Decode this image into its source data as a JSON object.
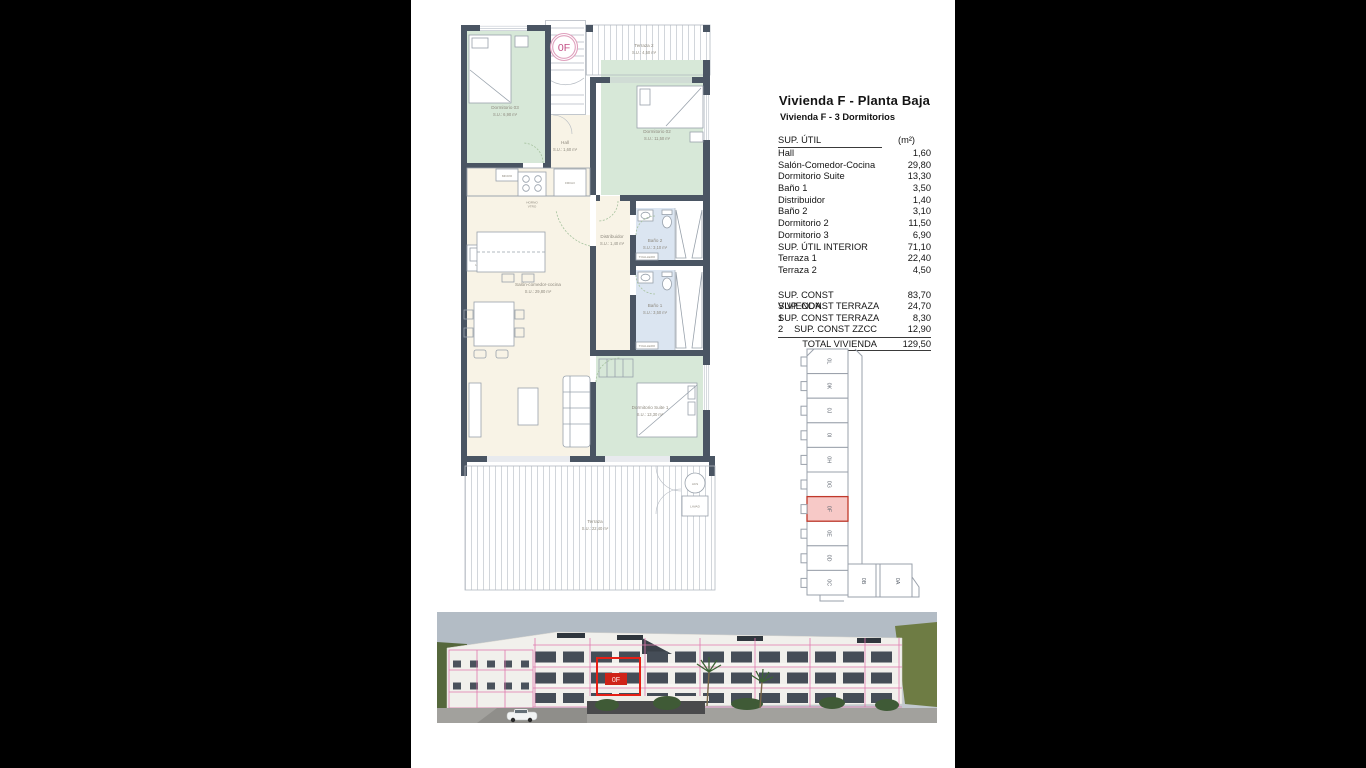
{
  "unit": {
    "code": "0F"
  },
  "header": {
    "title": "Vivienda F - Planta Baja",
    "subtitle": "Vivienda F - 3 Dormitorios"
  },
  "area_table": {
    "header_label": "SUP. ÚTIL",
    "header_unit": "(m²)",
    "rows": [
      {
        "label": "Hall",
        "value": "1,60"
      },
      {
        "label": "Salón-Comedor-Cocina",
        "value": "29,80"
      },
      {
        "label": "Dormitorio Suite",
        "value": "13,30"
      },
      {
        "label": "Baño 1",
        "value": "3,50"
      },
      {
        "label": "Distribuidor",
        "value": "1,40"
      },
      {
        "label": "Baño 2",
        "value": "3,10"
      },
      {
        "label": "Dormitorio 2",
        "value": "11,50"
      },
      {
        "label": "Dormitorio 3",
        "value": "6,90"
      },
      {
        "label": "SUP. ÚTIL INTERIOR",
        "value": "71,10"
      },
      {
        "label": "Terraza 1",
        "value": "22,40"
      },
      {
        "label": "Terraza 2",
        "value": "4,50"
      }
    ],
    "summary_rows": [
      {
        "label": "SUP. CONST VIVIENDA",
        "value": "83,70"
      },
      {
        "label": "SUP. CONST TERRAZA 1",
        "value": "24,70"
      },
      {
        "label": "SUP. CONST TERRAZA 2",
        "value": "8,30"
      },
      {
        "label": "SUP. CONST ZZCC",
        "value": "12,90"
      }
    ],
    "total_row": {
      "label": "TOTAL VIVIENDA",
      "value": "129,50"
    }
  },
  "floor_plan": {
    "rooms": {
      "terraza2": {
        "name": "Terraza 2",
        "area": "S.U.: 4,50 m²"
      },
      "dorm03": {
        "name": "Dormitorio 03",
        "area": "S.U.: 6,90 m²"
      },
      "dorm02": {
        "name": "Dormitorio 02",
        "area": "S.U.: 11,50 m²"
      },
      "hall": {
        "name": "Hall",
        "area": "S.U.: 1,60 m²"
      },
      "distribuidor": {
        "name": "Distribuidor",
        "area": "S.U.: 1,40 m²"
      },
      "bano2": {
        "name": "Baño 2",
        "area": "S.U.: 3,10 m²"
      },
      "bano1": {
        "name": "Baño 1",
        "area": "S.U.: 3,50 m²"
      },
      "salon": {
        "name": "Salón-comedor-cocina",
        "area": "S.U.: 29,80 m²"
      },
      "suite": {
        "name": "Dormitorio Suite 1",
        "area": "S.U.: 13,30 m²"
      },
      "terraza": {
        "name": "Terraza",
        "area": "S.U.: 22,40 m²"
      }
    },
    "fixtures": {
      "micro": "MICRO",
      "frigo": "FRIGO",
      "horno_line1": "HORNO",
      "horno_line2": "VTRO",
      "lava": "LAVA",
      "acs": "ACS",
      "lavad": "LAVAD",
      "toallero": "TOALLERO"
    }
  },
  "key_plan": {
    "units": [
      "0L",
      "0K",
      "0J",
      "0I",
      "0H",
      "0G",
      "0F",
      "0E",
      "0D",
      "0C"
    ],
    "bottom_units": [
      "0B",
      "0A"
    ],
    "highlighted_unit": "0F"
  },
  "colors": {
    "wall": "#4a5563",
    "bedroom_fill": "#d7e8d8",
    "living_fill": "#f8f3e6",
    "bath_fill": "#dbe5f1",
    "badge_magenta": "#c34f86",
    "keyplan_highlight_fill": "#f7c9c7",
    "keyplan_highlight_border": "#c0392b",
    "render_overlay_pink": "#e078ae",
    "render_overlay_red": "#e51f15"
  }
}
